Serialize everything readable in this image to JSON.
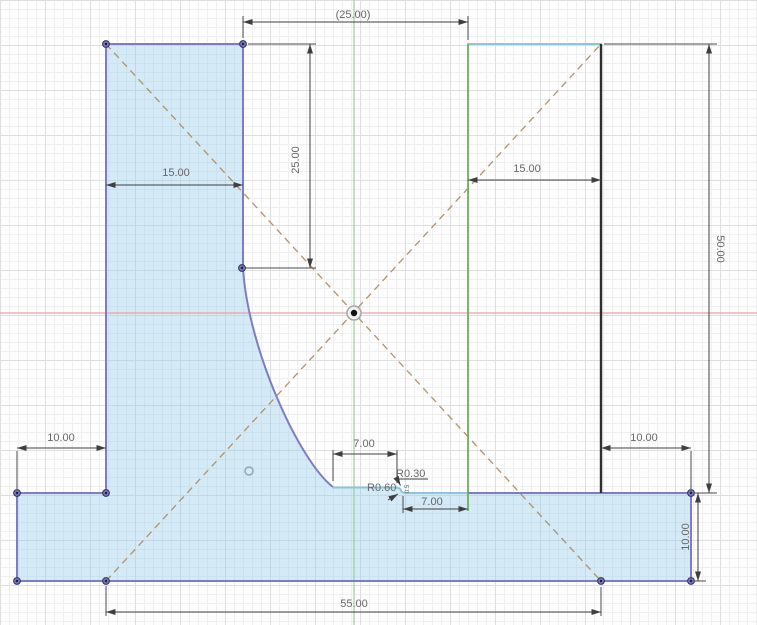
{
  "app": {
    "view_label": "cad-sketch-canvas"
  },
  "canvas": {
    "width": 757,
    "height": 625,
    "colors": {
      "profile_fill": "rgba(150,205,235,0.40)",
      "edge_normal": "#7d7dc4",
      "edge_tangent": "#8ac6dc",
      "edge_black": "#2e2e2e",
      "edge_green": "#6fae5c",
      "construction": "#b39268",
      "dimension_line": "#3f3f3f",
      "dimension_text": "#686868",
      "x_axis": "#e9a4a4",
      "y_axis": "#9ccf9c"
    }
  },
  "dimensions": {
    "ref_width_top": "(25.00)",
    "left_block_width": "15.00",
    "left_block_height": "25.00",
    "right_block_width": "15.00",
    "overall_height": "50.00",
    "base_left_offset": "10.00",
    "slot_width_top": "7.00",
    "radius_small": "R0.30",
    "radius_large": "R0.60",
    "step_dim": "0.5",
    "slot_width_bottom": "7.00",
    "base_right_offset": "10.00",
    "base_height": "10.00",
    "base_width": "55.00"
  }
}
